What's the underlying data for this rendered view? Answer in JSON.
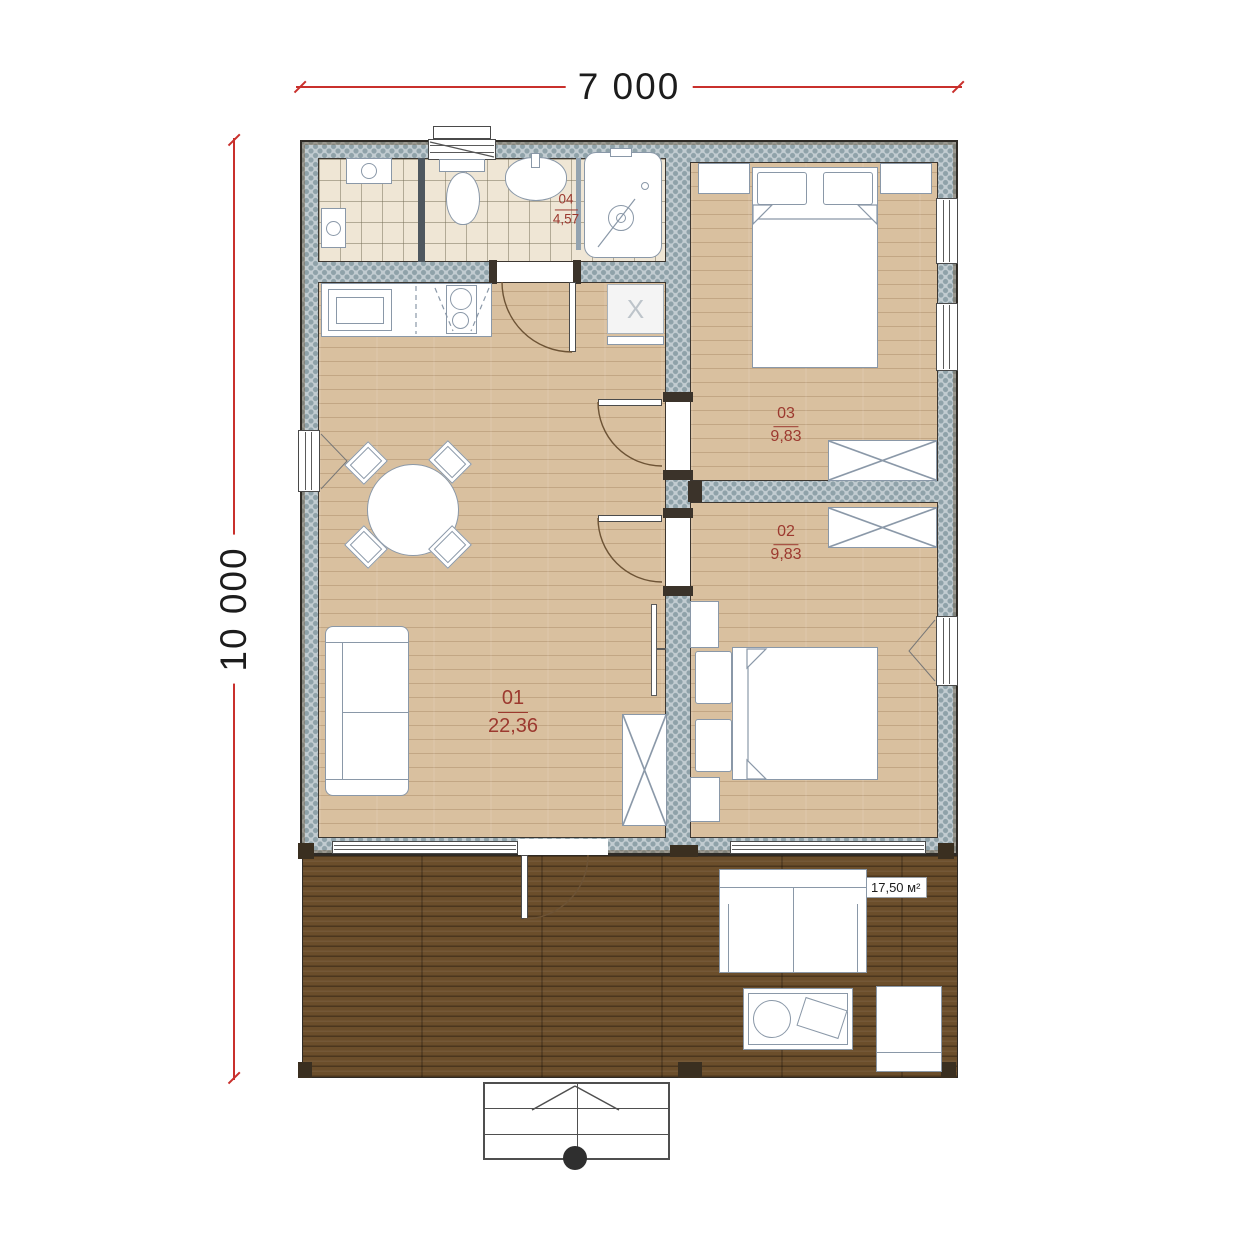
{
  "title": "house-floor-plan",
  "dimensions": {
    "width": "7 000",
    "height": "10 000"
  },
  "rooms": {
    "living": {
      "number": "01",
      "area": "22,36"
    },
    "bedroom_front": {
      "number": "02",
      "area": "9,83"
    },
    "bedroom_back": {
      "number": "03",
      "area": "9,83"
    },
    "bathroom": {
      "number": "04",
      "area": "4,57"
    }
  },
  "terrace": {
    "area_label": "17,50 м²"
  },
  "marks": {
    "appliance": "X"
  },
  "colors": {
    "dimension_line": "#c9302c",
    "room_label": "#9c392f",
    "wall_fill": "#c2ccd1",
    "wood_floor": "#d9c09f",
    "tile_floor": "#efe6d5",
    "deck": "#6b4e2b",
    "furniture_stroke": "#8a98a8"
  }
}
